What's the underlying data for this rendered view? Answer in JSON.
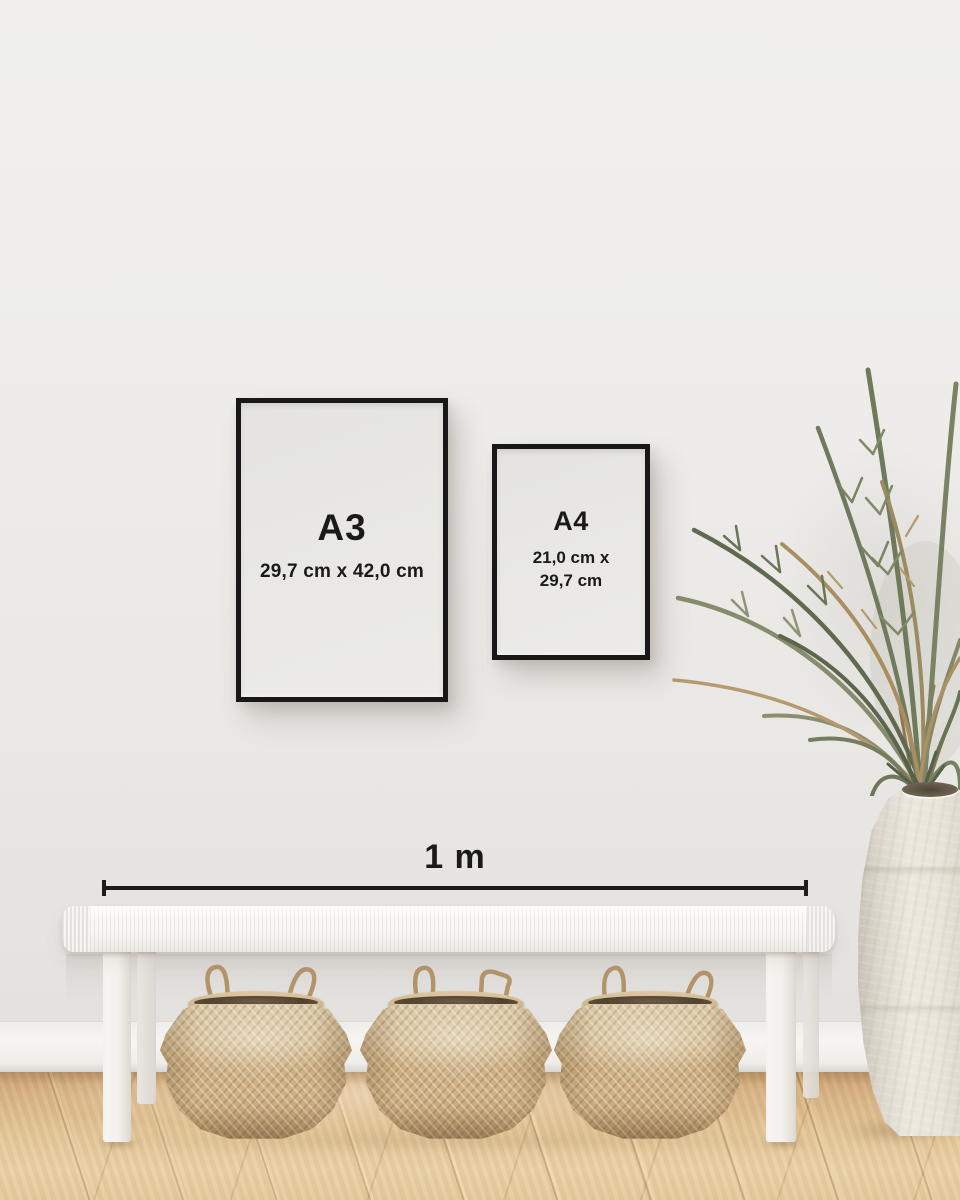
{
  "frames": {
    "a3": {
      "label": "A3",
      "dimensions": "29,7 cm x 42,0 cm"
    },
    "a4": {
      "label": "A4",
      "dimensions_line1": "21,0 cm x",
      "dimensions_line2": "29,7 cm"
    }
  },
  "scale": {
    "label": "1 m"
  },
  "scene": {
    "objects": [
      "wall",
      "baseboard",
      "wood-floor",
      "white-bench",
      "seagrass-basket-left",
      "seagrass-basket-middle",
      "seagrass-basket-right",
      "palm-plant",
      "ceramic-vase"
    ]
  },
  "colors": {
    "frame_black": "#181818",
    "annotation_text": "#1a1a1a",
    "wall": "#ebe9e6",
    "baseboard": "#f4f3f0",
    "floor_wood": "#e0bf92",
    "bench_white": "#f5f3f0",
    "basket_tan": "#cbad80",
    "plant_green": "#75805f",
    "plant_dried": "#ad9267",
    "vase_cream": "#e9e5dc"
  }
}
